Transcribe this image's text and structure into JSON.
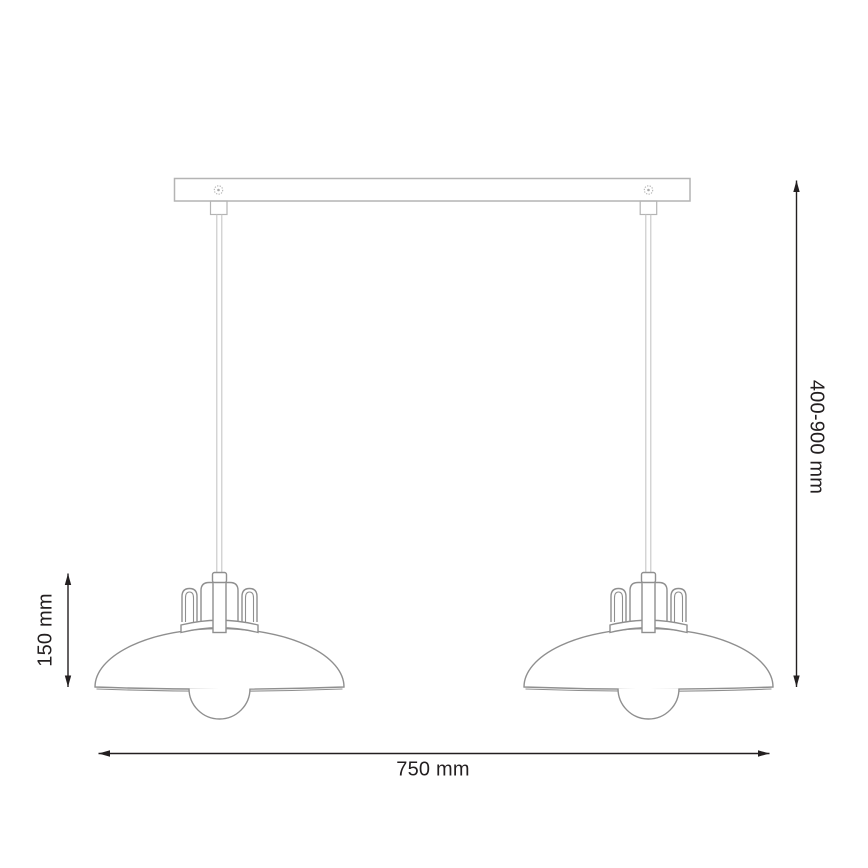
{
  "dimensions": {
    "overall_width": "750 mm",
    "suspension_height": "400-900 mm",
    "shade_height": "150 mm"
  },
  "icons": {
    "left_screw": "screw-icon",
    "right_screw": "screw-icon"
  },
  "colors": {
    "dimension_ink": "#231f20",
    "rail_line": "#b4b4b4",
    "cord_line": "#c6c6c6",
    "lamp_line": "#8f8f8f",
    "background": "#ffffff"
  }
}
